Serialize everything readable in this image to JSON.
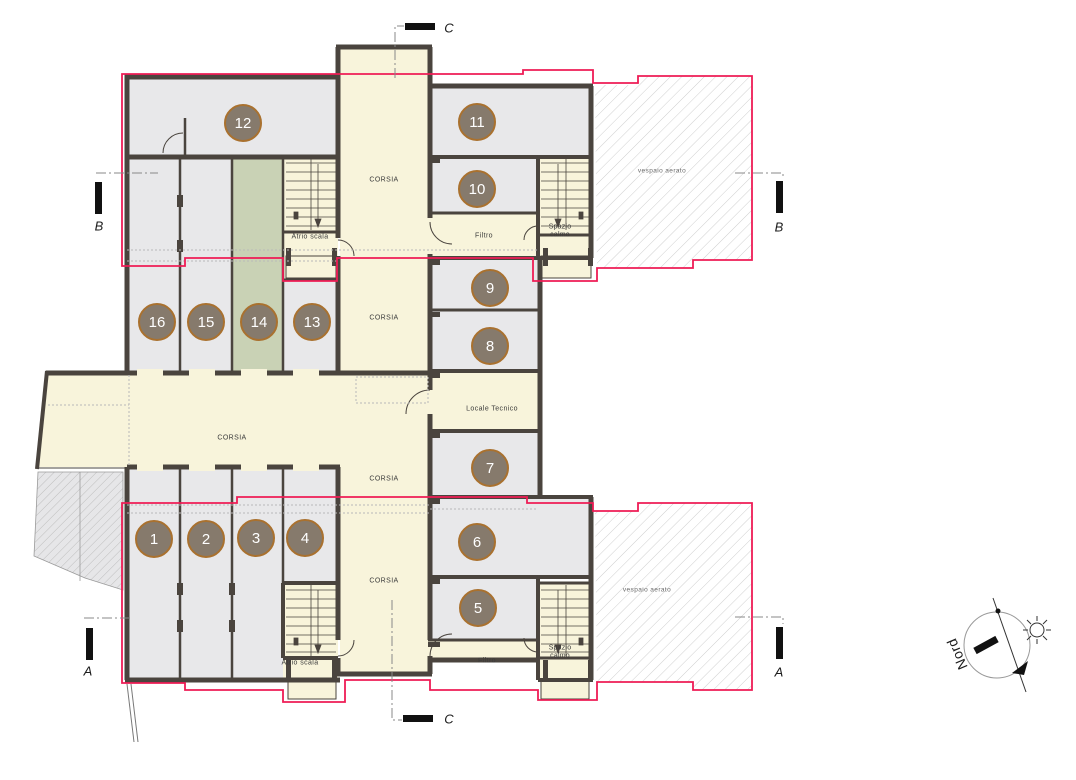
{
  "floor_plan": {
    "room_numbers": [
      "1",
      "2",
      "3",
      "4",
      "5",
      "6",
      "7",
      "8",
      "9",
      "10",
      "11",
      "12",
      "13",
      "14",
      "15",
      "16"
    ],
    "corridor_label": "CORSIA",
    "area_labels": {
      "atrio_scala": "Atrio scala",
      "filtro": "Filtro",
      "spazio_calmo": "Spazio calmo",
      "locale_tecnico": "Locale Tecnico",
      "vespaio_aerato": "vespaio aerato"
    },
    "section_markers": {
      "a": "A",
      "b": "B",
      "c": "C"
    },
    "compass": {
      "north_label": "Nord"
    },
    "colors": {
      "room_fill": "#e8e8ea",
      "corridor_fill": "#f8f4db",
      "highlight_room_fill": "#c9d2b5",
      "wall": "#4a443e",
      "perimeter_line": "#ee1c55",
      "room_badge_fill": "#867a6c",
      "room_badge_border": "#a9712f"
    }
  }
}
